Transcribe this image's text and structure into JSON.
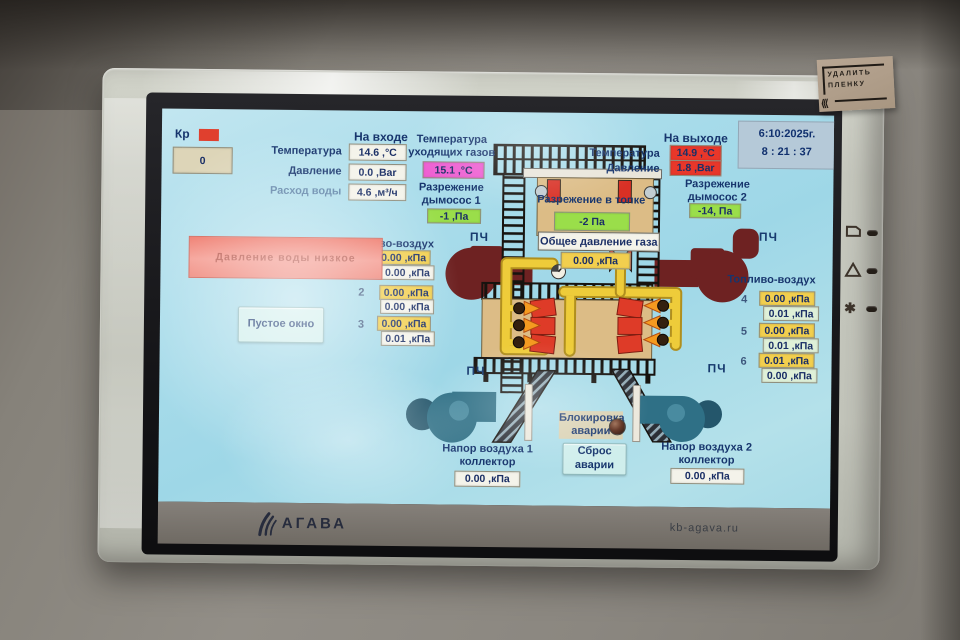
{
  "panel": {
    "sticker_line1": "УДАЛИТЬ",
    "sticker_line2": "ПЛЕНКУ",
    "brand": "АГАВА",
    "site": "kb-agava.ru"
  },
  "icons": {
    "display": "display-outline",
    "warning": "triangle-outline",
    "asterisk": "✱",
    "agava_logo": "three-leaf-sprout"
  },
  "screen": {
    "datetime": {
      "date": "6:10:2025г.",
      "time": "8 : 21 : 37"
    },
    "valve": {
      "label": "Кр",
      "value": "0"
    },
    "inlet": {
      "header": "На входе",
      "rows": [
        {
          "label": "Температура",
          "value": "14.6 ,°C"
        },
        {
          "label": "Давление",
          "value": "0.0 ,Bar"
        },
        {
          "label": "Расход воды",
          "value": "4.6 ,м³/ч"
        }
      ]
    },
    "flue_gas": {
      "label": "Температура уходящих газов",
      "value": "15.1 ,°C"
    },
    "draft_fan1": {
      "label": "Разрежение дымосос 1",
      "value": "-1 ,Па"
    },
    "furnace_draft": {
      "label": "Разрежение в топке",
      "value": "-2 Па"
    },
    "total_gas": {
      "label": "Общее давление газа",
      "value": "0.00 ,кПа"
    },
    "outlet": {
      "header": "На выходе",
      "rows": [
        {
          "label": "Температура",
          "value": "14.9 ,°C"
        },
        {
          "label": "Давление",
          "value": "1.8 ,Bar"
        }
      ]
    },
    "draft_fan2": {
      "label": "Разрежение дымосос 2",
      "value": "-14, Па"
    },
    "alarm_banner": "Давление воды низкое",
    "empty_window": "Пустое окно",
    "fuel_air_left": {
      "header": "Топливо-воздух",
      "rows": [
        {
          "index": "1",
          "set": "0.00 ,кПа",
          "actual": "0.00 ,кПа"
        },
        {
          "index": "2",
          "set": "0.00 ,кПа",
          "actual": "0.00 ,кПа"
        },
        {
          "index": "3",
          "set": "0.00 ,кПа",
          "actual": "0.01 ,кПа"
        }
      ]
    },
    "fuel_air_right": {
      "header": "Топливо-воздух",
      "rows": [
        {
          "index": "4",
          "set": "0.00 ,кПа",
          "actual": "0.01 ,кПа"
        },
        {
          "index": "5",
          "set": "0.00 ,кПа",
          "actual": "0.01 ,кПа"
        },
        {
          "index": "6",
          "set": "0.01 ,кПа",
          "actual": "0.00 ,кПа"
        }
      ]
    },
    "vfd": "ПЧ",
    "alarm_lock": "Блокировка аварии",
    "alarm_reset": "Сброс аварии",
    "air_header1": {
      "label": "Напор воздуха 1 коллектор",
      "value": "0.00 ,кПа"
    },
    "air_header2": {
      "label": "Напор воздуха 2 коллектор",
      "value": "0.00 ,кПа"
    }
  },
  "colors": {
    "screen_bg": "#a9dcea",
    "label_text": "#17356d",
    "value_green": "#9ade4a",
    "value_yellow": "#f2cf4e",
    "value_magenta": "#ee5fd2",
    "value_red": "#e8372a",
    "alarm_banner": "#f08578",
    "boiler_tan": "#dcbc86",
    "flue_maroon": "#6e2222",
    "gas_pipe_yellow": "#eecc3a",
    "fan_teal": "#2f7086"
  }
}
